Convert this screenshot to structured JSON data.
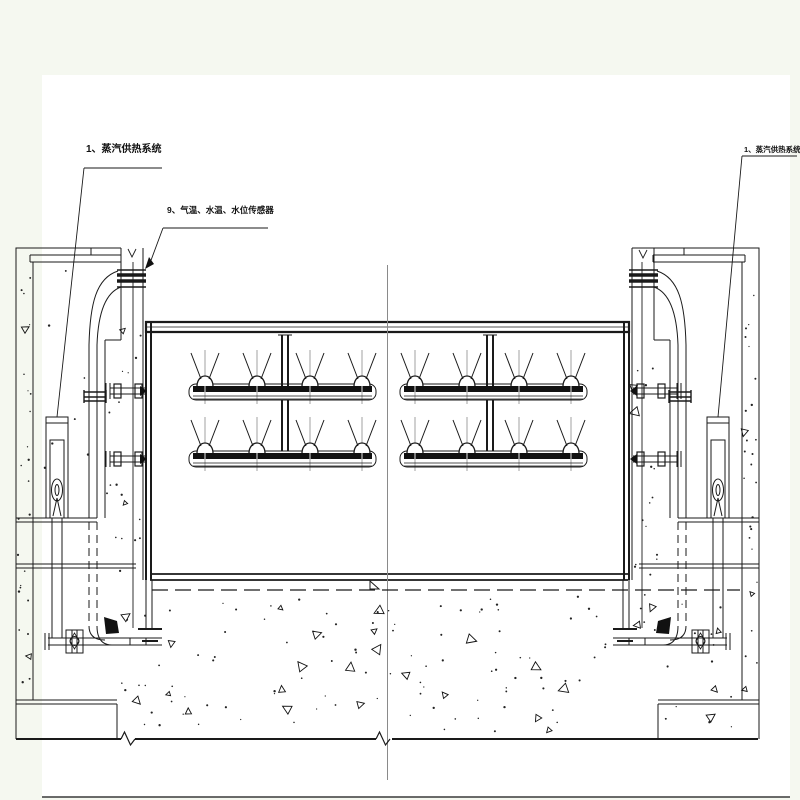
{
  "drawing": {
    "labels": {
      "left_system": {
        "number": "1",
        "text": "1、蒸汽供热系统"
      },
      "sensors": {
        "number": "9",
        "text": "9、气温、水温、水位传感器"
      },
      "right_system": {
        "number": "1",
        "text": "1、蒸汽供热系统"
      }
    },
    "colors": {
      "background": "#f5f8f0",
      "paper": "#ffffff",
      "line": "#1a1a1a",
      "centerline": "#8a8a8a"
    },
    "nozzle_layout": {
      "columns_x": [
        205,
        257,
        310,
        362,
        415,
        467,
        519,
        571
      ],
      "row_base_y": [
        386,
        453
      ],
      "feed_pipe_x": [
        285,
        490
      ],
      "manifold_spans": [
        [
          193,
          372
        ],
        [
          404,
          583
        ]
      ],
      "nozzles_per_row": 8,
      "rows": 2
    },
    "coupling_rows_y": [
      391,
      459
    ],
    "speckle_regions": [
      {
        "x": 18,
        "y": 262,
        "w": 13,
        "h": 430,
        "dots": 24,
        "tris": 2
      },
      {
        "x": 36,
        "y": 268,
        "w": 55,
        "h": 230,
        "dots": 7,
        "tris": 0
      },
      {
        "x": 107,
        "y": 330,
        "w": 34,
        "h": 255,
        "dots": 16,
        "tris": 2
      },
      {
        "x": 120,
        "y": 598,
        "w": 42,
        "h": 130,
        "dots": 10,
        "tris": 2
      },
      {
        "x": 166,
        "y": 596,
        "w": 440,
        "h": 136,
        "dots": 85,
        "tris": 20
      },
      {
        "x": 632,
        "y": 360,
        "w": 26,
        "h": 300,
        "dots": 18,
        "tris": 4
      },
      {
        "x": 660,
        "y": 598,
        "w": 78,
        "h": 130,
        "dots": 12,
        "tris": 3
      },
      {
        "x": 744,
        "y": 262,
        "w": 13,
        "h": 430,
        "dots": 24,
        "tris": 3
      }
    ]
  }
}
